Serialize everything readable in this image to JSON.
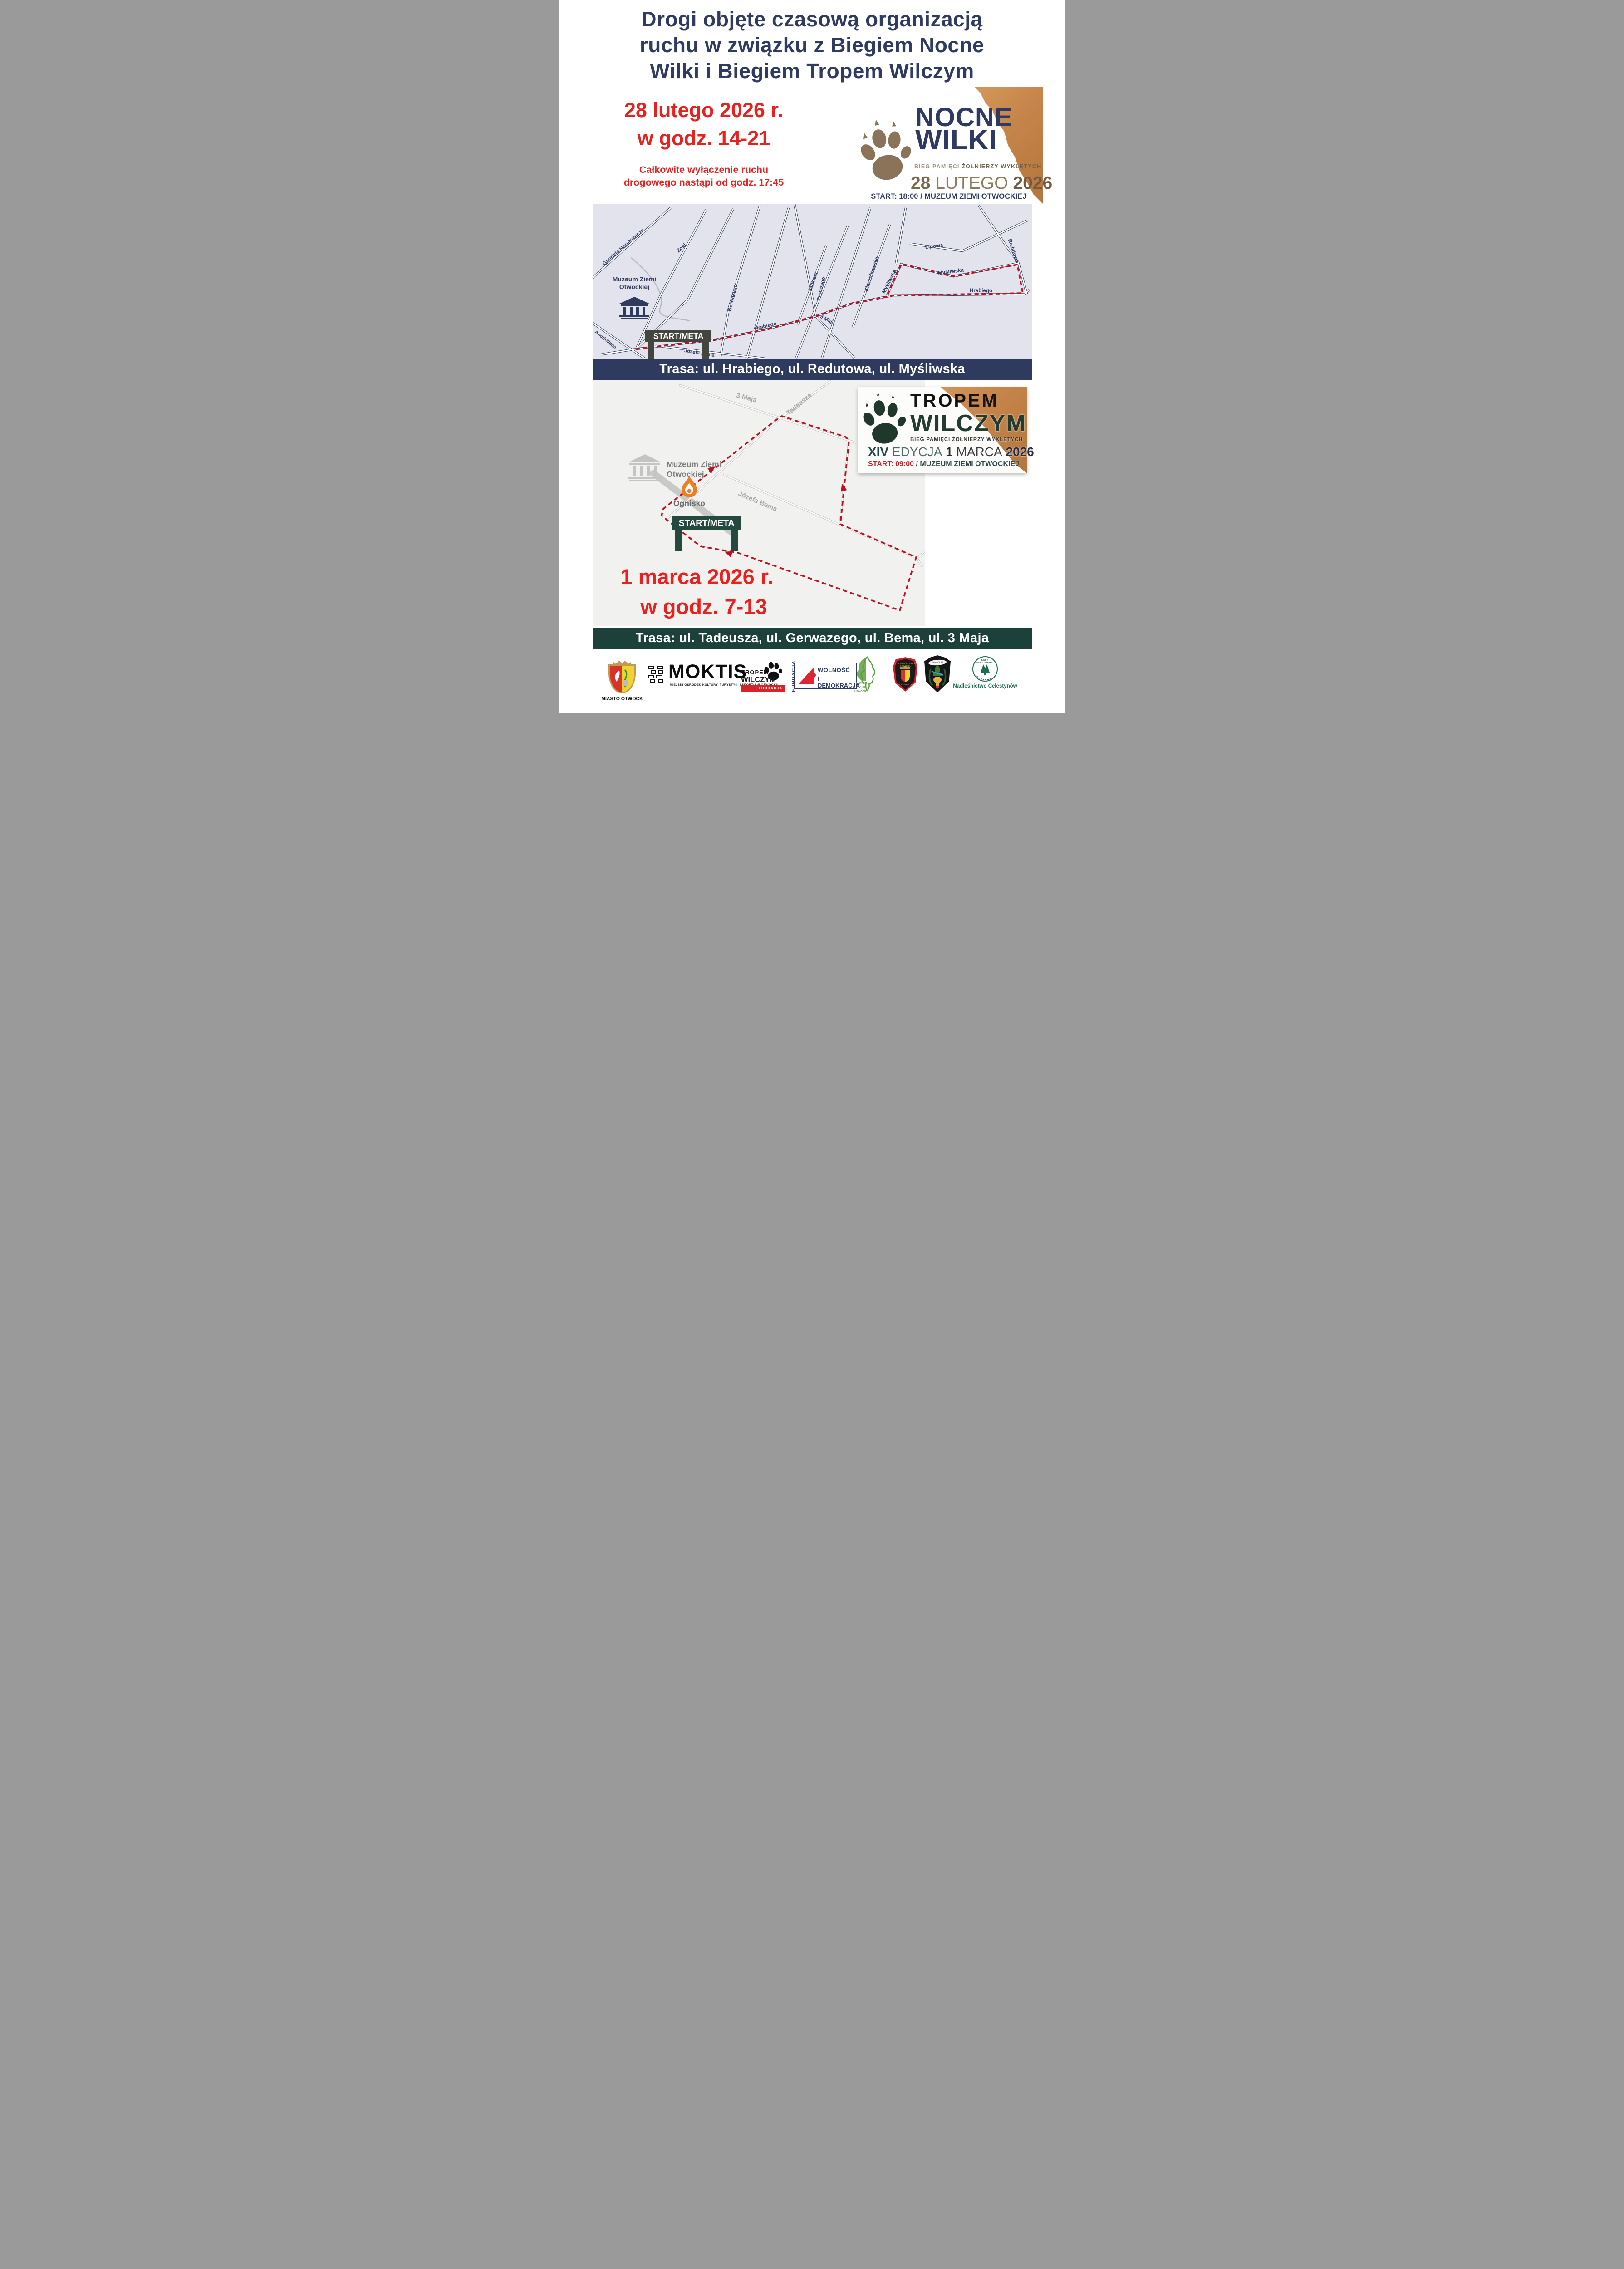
{
  "title": {
    "line1": "Drogi objęte czasową organizacją",
    "line2": "ruchu w związku z Biegiem Nocne",
    "line3": "Wilki i Biegiem Tropem Wilczym"
  },
  "event1": {
    "date": "28 lutego 2026 r.",
    "hours": "w godz. 14-21",
    "note1": "Całkowite wyłączenie ruchu",
    "note2": "drogowego nastąpi od godz. 17:45",
    "banner": "Trasa: ul. Hrabiego, ul. Redutowa, ul. Myśliwska",
    "logo": {
      "name1": "NOCNE",
      "name2": "WILKI",
      "sub_light": "BIEG PAMIĘCI",
      "sub_dark": "ŻOŁNIERZY WYKLĘTYCH",
      "day": "28",
      "month": "LUTEGO",
      "year": "2026",
      "start": "START: 18:00 / MUZEUM ZIEMI OTWOCKIEJ"
    }
  },
  "map1": {
    "museum1": "Muzeum Ziemi",
    "museum2": "Otwockiej",
    "gate": "START/META",
    "streets": {
      "narutowicza": "Gabriela Narutowicza",
      "zosi": "Zosi",
      "gerwazego": "Gerwazego",
      "jankiela": "Jankiela",
      "protazego": "Protazego",
      "klucznikowska": "Klucznikowska",
      "mysliwska_v": "Myśliwska",
      "mysliwska_h": "Myśliwska",
      "lipowa": "Lipowa",
      "redutowa": "Redutowa",
      "hrabiego_w": "Hrabiego",
      "hrabiego_e": "Hrabiego",
      "maja3": "3 Maja",
      "bema": "Józefa Bema",
      "andriollego": "Andriollego"
    }
  },
  "event2": {
    "date": "1 marca 2026 r.",
    "hours": "w godz. 7-13",
    "banner": "Trasa: ul. Tadeusza, ul. Gerwazego, ul. Bema, ul. 3 Maja",
    "logo": {
      "name1": "TROPEM",
      "name2": "WILCZYM",
      "sub": "BIEG PAMIĘCI ŻOŁNIERZY WYKLĘTYCH",
      "ed_roman": "XIV",
      "ed_word": "EDYCJA",
      "ed_day": "1",
      "ed_month": "MARCA",
      "ed_year": "2026",
      "start_time": "START: 09:00",
      "start_place": "/ MUZEUM ZIEMI OTWOCKIEJ"
    }
  },
  "map2": {
    "museum1": "Muzeum Ziemi",
    "museum2": "Otwockiej",
    "ognisko": "Ognisko",
    "gate": "START/META",
    "streets": {
      "maja3": "3 Maja",
      "tadeusza": "Tadeusza",
      "bema": "Józefa Bema"
    }
  },
  "footer": {
    "miasto": "MIASTO OTWOCK",
    "moktis": "MOKTIS",
    "moktis_sub": "MIEJSKI OŚRODEK KULTURY, TURYSTYKI I SPORTU ",
    "moktis_sub_bold": "W OTWOCKU",
    "tw1": "TROPEM",
    "tw2": "WILCZYM",
    "tw_bar": "FUNDACJA",
    "fund_vert": "FUNDACJA",
    "wol1": "WOLNOŚĆ",
    "wol2": "I DEMOKRACJA",
    "zhp1": "Hufiec",
    "zhp2": "ZHP",
    "zhp3": "Otwock",
    "osp1_ring1": "OCHOTNICZA STRAŻ POŻARNA",
    "osp1_ring2": "OTWOCK-JABŁONNA",
    "osp2_banner": "OSP WÓLKA MLĄDZKA",
    "lasy_ring": "LASY PAŃSTWOWE",
    "lasy_caption": "Nadleśnictwo Celestynów"
  },
  "colors": {
    "navy": "#2e3a5e",
    "red": "#e8211f",
    "route_red": "#c01020",
    "teal_banner": "#1c403a",
    "map1_bg": "#e3e3ed",
    "map2_bg": "#f1f1ef",
    "cardboard": "#c98c4e",
    "paw_brown": "#8a7358",
    "paw_green": "#20372c",
    "gate1": "#45453f",
    "gate2": "#26493f"
  }
}
